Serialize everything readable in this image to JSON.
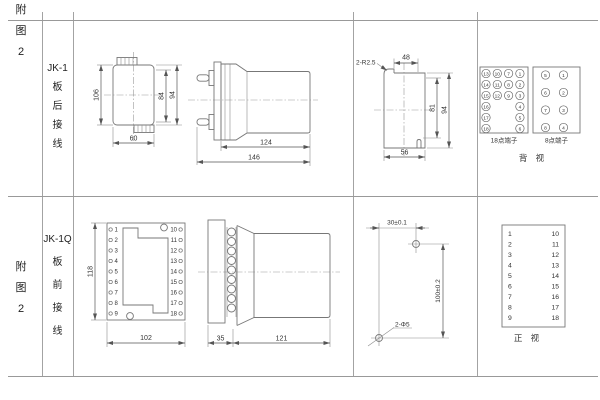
{
  "row1": {
    "fig_label": "附\n图\n2",
    "model_label": "JK-1\n板\n后\n接\n线",
    "front": {
      "h": "106",
      "inner_h": "84",
      "outer_h": "94",
      "w": "60"
    },
    "side": {
      "body": "124",
      "total": "146"
    },
    "cutout": {
      "corner": "2-R2.5",
      "top": "48",
      "inner_h": "81",
      "h": "94",
      "w": "56"
    },
    "terminals": {
      "block18_label": "18点端子",
      "block8_label": "8点端子",
      "view_label": "背 视",
      "b18_col1": [
        "13",
        "14",
        "15",
        "16",
        "17",
        "18"
      ],
      "b18_col2": [
        "10",
        "11",
        "12"
      ],
      "b18_col3": [
        "7",
        "8",
        "9"
      ],
      "b18_col4": [
        "1",
        "2",
        "3",
        "4",
        "5",
        "6"
      ],
      "b8_left": [
        "5",
        "6",
        "7",
        "8"
      ],
      "b8_right": [
        "1",
        "2",
        "3",
        "4"
      ]
    }
  },
  "row2": {
    "fig_label": "附\n图\n2",
    "model_label": "JK-1Q\n板\n前\n接\n线",
    "front": {
      "h": "118",
      "w": "102",
      "left": [
        "1",
        "2",
        "3",
        "4",
        "5",
        "6",
        "7",
        "8",
        "9"
      ],
      "right": [
        "10",
        "11",
        "12",
        "13",
        "14",
        "15",
        "16",
        "17",
        "18"
      ]
    },
    "side": {
      "flange": "35",
      "body": "121"
    },
    "drill": {
      "h": "30±0.1",
      "v": "100±0.2",
      "holes": "2-Φ5"
    },
    "table": {
      "left": [
        "1",
        "2",
        "3",
        "4",
        "5",
        "6",
        "7",
        "8",
        "9"
      ],
      "right": [
        "10",
        "11",
        "12",
        "13",
        "14",
        "15",
        "16",
        "17",
        "18"
      ],
      "view_label": "正 视"
    }
  }
}
